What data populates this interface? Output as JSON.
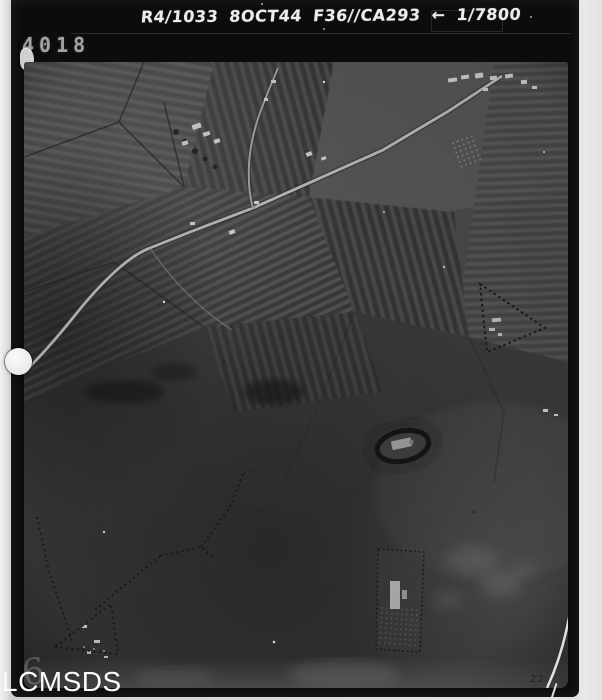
{
  "frame": {
    "annotation": "R4/1033 8OCT44 F36//CA293 ← 1/7800",
    "frame_number": "4018",
    "ghost_mark": "6",
    "corner_mark": "22"
  },
  "watermark": {
    "label": "LCMSDS"
  },
  "photo": {
    "type": "monochrome vertical aerial reconnaissance photograph",
    "features": [
      "patchwork-fields",
      "main-road",
      "secondary-road",
      "village-buildings",
      "orchard-grid",
      "triangular-enclosure",
      "ringed-enclosure",
      "rectangular-enclosure",
      "hedgerow-boundaries",
      "punch-hole",
      "emulsion-scratch"
    ]
  },
  "colors": {
    "strip_background": "#0c0c0c",
    "annotation_ink": "#ececec",
    "frame_number_ink": "#a3a3a3",
    "margin_paper": "#e9e9e9",
    "photo_base": "#4a4a4a",
    "road_highlight": "#b7b7b7",
    "watermark_ink": "#fbfbfb"
  }
}
